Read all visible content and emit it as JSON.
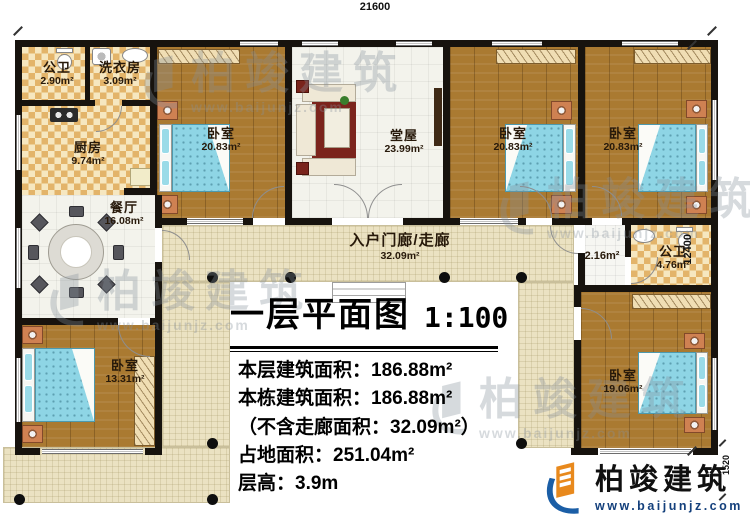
{
  "dimensions": {
    "top": "21600",
    "right": "12400",
    "bottom_right": "1520"
  },
  "rooms": {
    "bath1": {
      "name": "公卫",
      "area": "2.90m²"
    },
    "laundry": {
      "name": "洗衣房",
      "area": "3.09m²"
    },
    "kitchen": {
      "name": "厨房",
      "area": "9.74m²"
    },
    "dining": {
      "name": "餐厅",
      "area": "16.08m²"
    },
    "bedroom_top_left": {
      "name": "卧室",
      "area": "20.83m²"
    },
    "hall": {
      "name": "堂屋",
      "area": "23.99m²"
    },
    "bedroom_top_mid": {
      "name": "卧室",
      "area": "20.83m²"
    },
    "bedroom_top_right": {
      "name": "卧室",
      "area": "20.83m²"
    },
    "vestibule": {
      "area": "2.16m²"
    },
    "bath2": {
      "name": "公卫",
      "area": "4.76m²"
    },
    "bedroom_bottom_right": {
      "name": "卧室",
      "area": "19.06m²"
    },
    "bedroom_bottom_left": {
      "name": "卧室",
      "area": "13.31m²"
    },
    "corridor": {
      "name": "入户门廊/走廊",
      "area": "32.09m²"
    }
  },
  "title_block": {
    "title": "一层平面图",
    "scale": "1:100",
    "lines": [
      "本层建筑面积：186.88m²",
      "本栋建筑面积：186.88m²",
      "（不含走廊面积：32.09m²）",
      "占地面积：251.04m²",
      "层高：3.9m"
    ]
  },
  "watermark": {
    "text": "柏竣建筑",
    "url": "www.baijunjz.com"
  },
  "logo": {
    "text": "柏竣建筑",
    "url": "www.baijunjz.com"
  },
  "colors": {
    "wall": "#17130e",
    "wood_floor": "#aa7a31",
    "checker_tile": "#e3b46a",
    "walkway": "#ebe2c2",
    "bed": "#8ed5e5",
    "logo_blue": "#1b5ea6",
    "logo_orange": "#e8891d"
  }
}
